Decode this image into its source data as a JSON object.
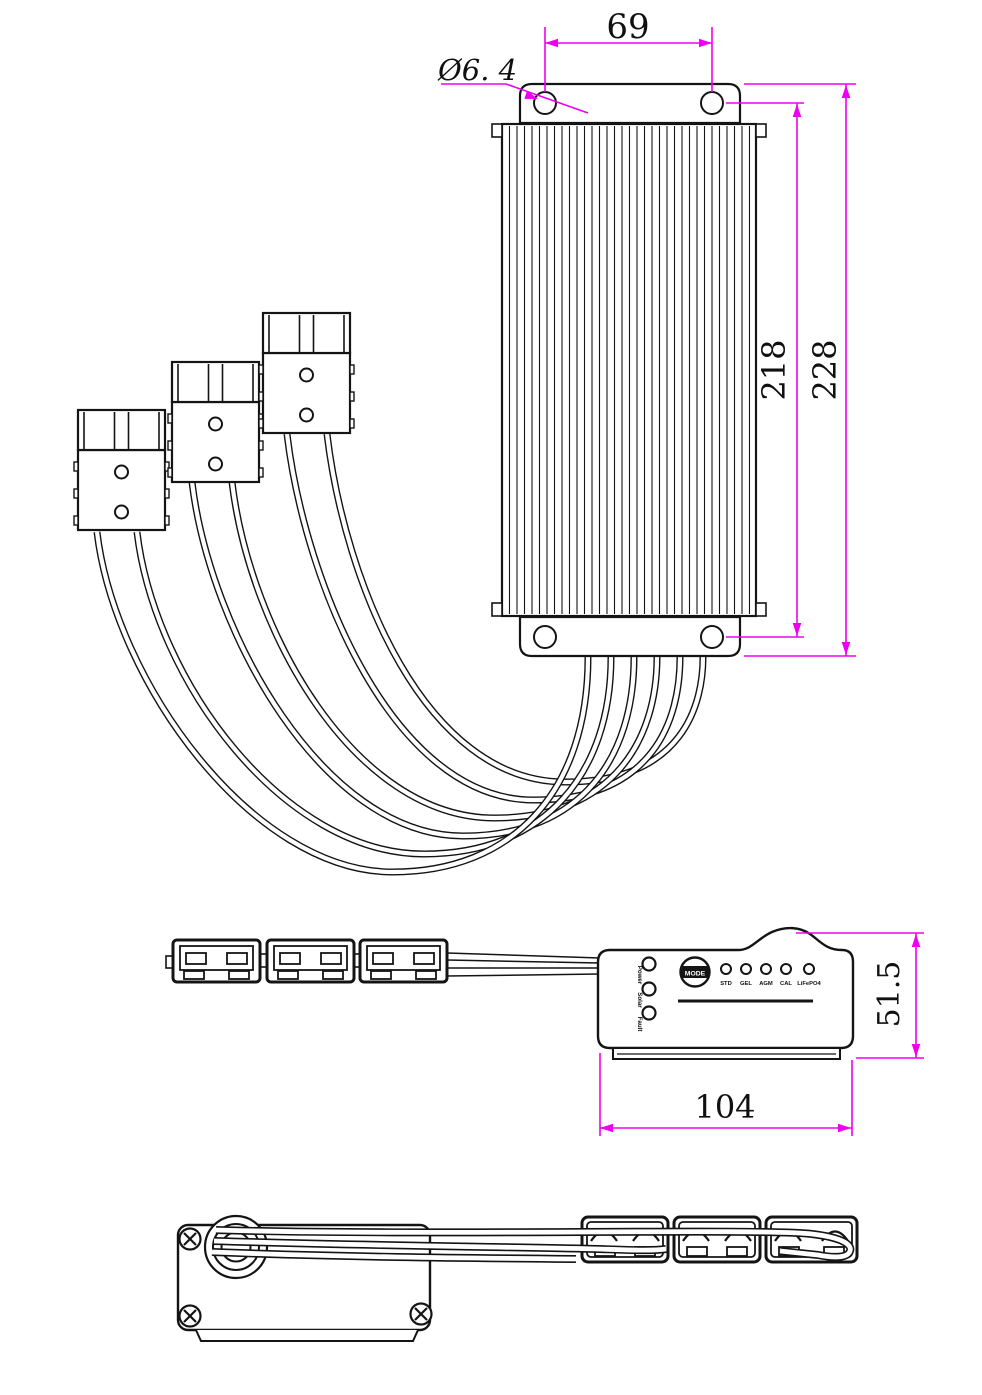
{
  "drawing": {
    "colors": {
      "dimension": "#EE00EE",
      "line": "#141414"
    },
    "top_view": {
      "dim_hole_spacing": "69",
      "dim_hole_diameter": "Ø6. 4",
      "dim_fin_body_height": "218",
      "dim_overall_height": "228"
    },
    "side_view": {
      "dim_height": "51.5",
      "dim_width": "104",
      "panel": {
        "status_leds": [
          "Power",
          "Solar",
          "Fault"
        ],
        "mode_button_label": "MODE",
        "mode_leds": [
          "STD",
          "GEL",
          "AGM",
          "CAL",
          "LiFePO4"
        ]
      }
    }
  }
}
